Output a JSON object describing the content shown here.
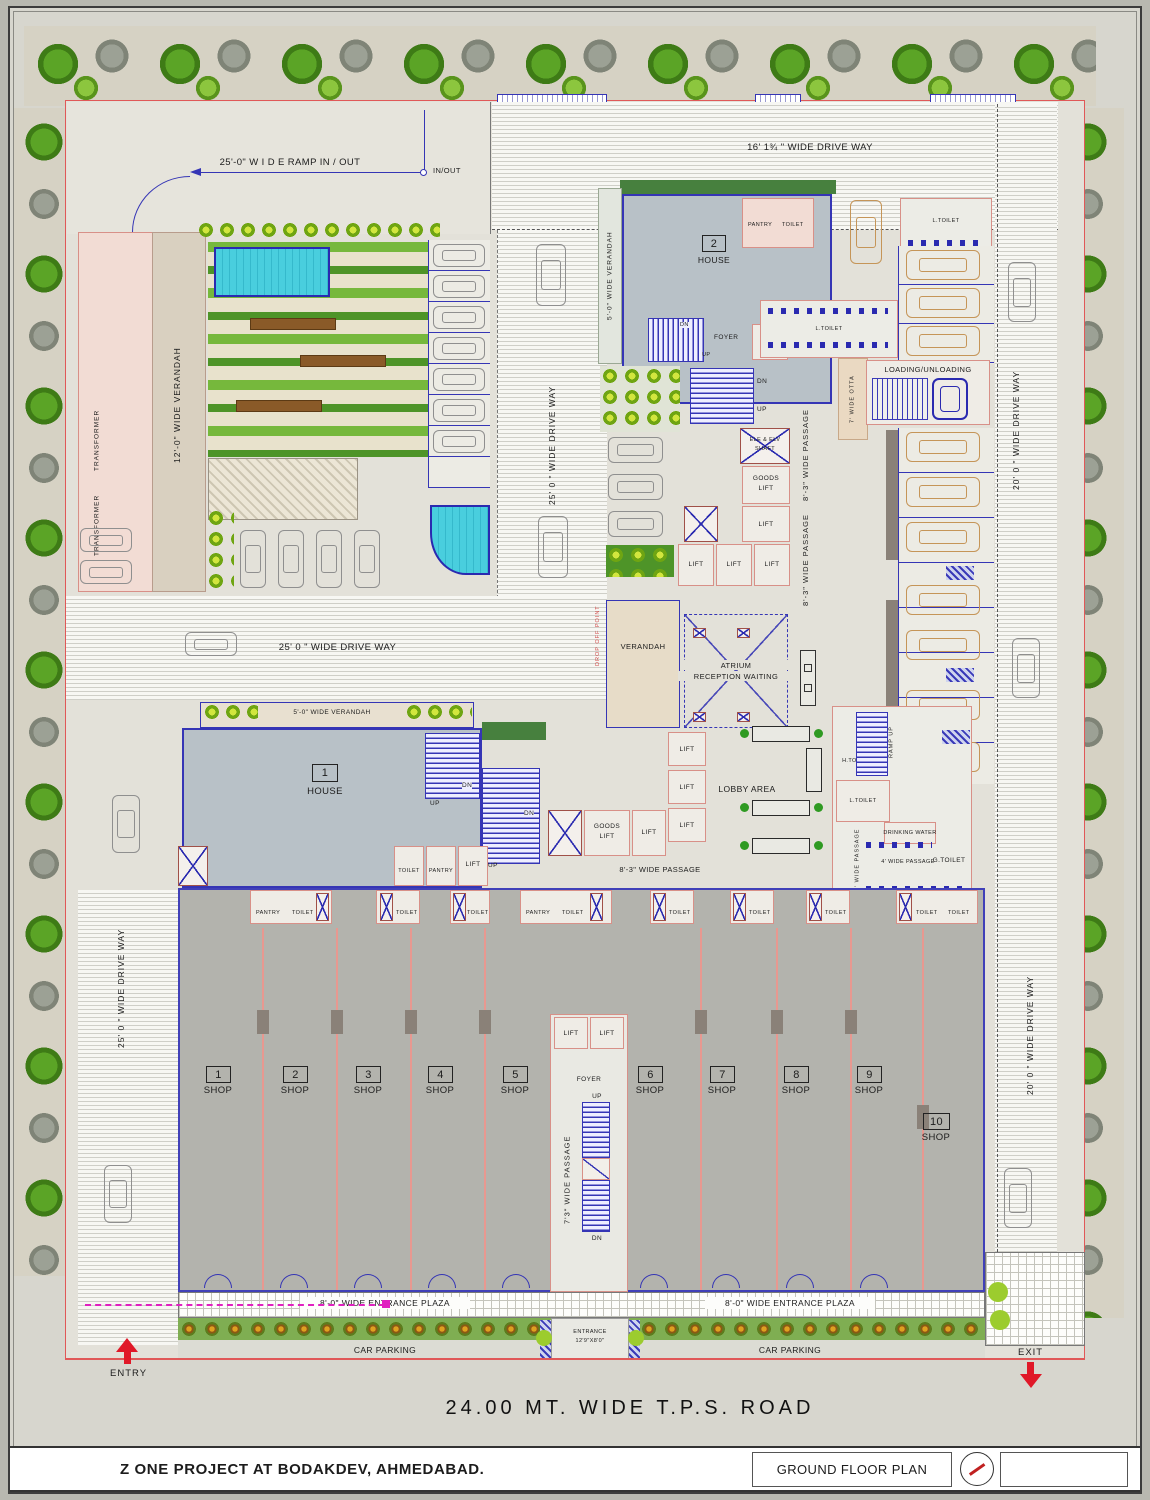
{
  "sheet": {
    "project_title": "Z ONE PROJECT  AT BODAKDEV, AHMEDABAD.",
    "drawing_title": "GROUND  FLOOR  PLAN",
    "road_label": "24.00  MT.  WIDE  T.P.S.  ROAD"
  },
  "site": {
    "entry": "ENTRY",
    "exit": "EXIT",
    "ramp_label": "25'-0\"  W I D E  RAMP IN / OUT",
    "in_out": "IN/OUT",
    "driveway_16": "16' 1¾ \" WIDE   DRIVE   WAY",
    "driveway_25_center": "25' 0 \" WIDE   DRIVE   WAY",
    "driveway_25_mid": "25' 0 \" WIDE   DRIVE  WAY",
    "driveway_25_left": "25' 0 \" WIDE  DRIVE  WAY",
    "driveway_20_top": "20' 0 \" WIDE   DRIVE   WAY",
    "driveway_20_bottom": "20' 0 \" WIDE  DRIVE  WAY"
  },
  "areas": {
    "verandah_12": "12'-0\" WIDE VERANDAH",
    "transformer": "TRANSFORMER",
    "verandah_5": "5'-0\" WIDE VERANDAH",
    "verandah": "VERANDAH",
    "drop_off": "DROP OFF POINT",
    "otta_7": "7' WIDE OTTA",
    "loading": "LOADING/UNLOADING",
    "atrium_line1": "ATRIUM",
    "atrium_line2": "RECEPTION WAITING",
    "lobby": "LOBBY AREA",
    "foyer": "FOYER",
    "ramp_up": "RAMP UP",
    "passage_83": "8'-3\" WIDE PASSAGE",
    "passage_73": "7'3\" WIDE PASSAGE",
    "passage_4": "4' WIDE PASSAGE",
    "drinking": "DRINKING WATER",
    "entrance_plaza": "8'-0\" WIDE ENTRANCE PLAZA",
    "car_parking": "CAR PARKING",
    "entrance_line1": "ENTRANCE",
    "entrance_line2": "12'9\"X8'0\""
  },
  "rooms": {
    "house": "HOUSE",
    "house1_no": "1",
    "house2_no": "2",
    "lift": "LIFT",
    "goods": "GOODS",
    "shaft_line1": "ELE & ELV",
    "shaft_line2": "SHAFT",
    "pantry": "PANTRY",
    "toilet": "TOILET",
    "l_toilet": "L.TOILET",
    "h_toilet": "H.TOILET",
    "g_toilet": "G.TOILET",
    "up": "UP",
    "dn": "DN"
  },
  "shops": [
    {
      "no": "1",
      "label": "SHOP"
    },
    {
      "no": "2",
      "label": "SHOP"
    },
    {
      "no": "3",
      "label": "SHOP"
    },
    {
      "no": "4",
      "label": "SHOP"
    },
    {
      "no": "5",
      "label": "SHOP"
    },
    {
      "no": "6",
      "label": "SHOP"
    },
    {
      "no": "7",
      "label": "SHOP"
    },
    {
      "no": "8",
      "label": "SHOP"
    },
    {
      "no": "9",
      "label": "SHOP"
    },
    {
      "no": "10",
      "label": "SHOP"
    }
  ],
  "colors": {
    "boundary_red": "#e05858",
    "wall_blue": "#3535b5",
    "wall_pink": "#d89088",
    "tree_green": "#5ba426",
    "arrow_red": "#e01828",
    "path_magenta": "#e020c0"
  }
}
